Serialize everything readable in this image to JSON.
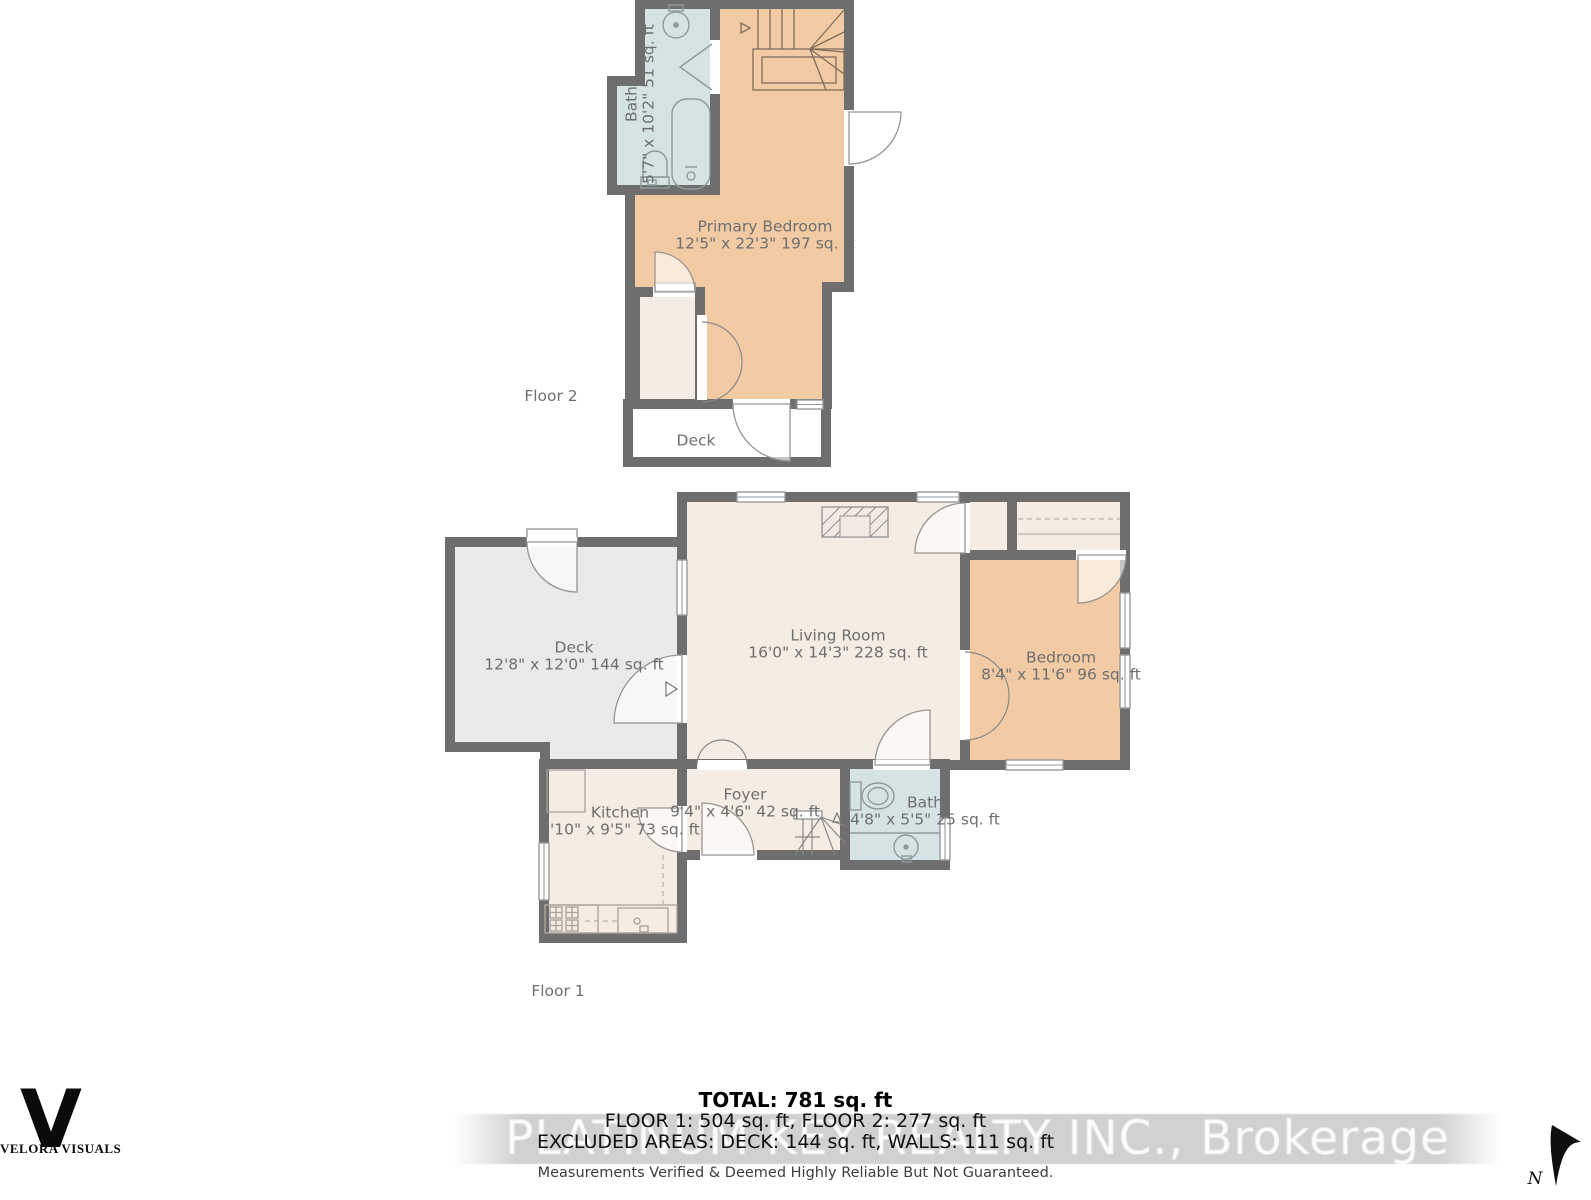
{
  "floor2": {
    "label": "Floor 2",
    "bath": {
      "name": "Bath",
      "dims": "5'7\" x 10'2\" 51 sq. ft"
    },
    "primary_bedroom": {
      "name": "Primary Bedroom",
      "dims": "12'5\" x 22'3\" 197 sq. ft"
    },
    "deck": {
      "name": "Deck"
    }
  },
  "floor1": {
    "label": "Floor 1",
    "deck": {
      "name": "Deck",
      "dims": "12'8\" x 12'0\" 144 sq. ft"
    },
    "living_room": {
      "name": "Living Room",
      "dims": "16'0\" x 14'3\" 228 sq. ft"
    },
    "bedroom": {
      "name": "Bedroom",
      "dims": "8'4\" x 11'6\" 96 sq. ft"
    },
    "kitchen": {
      "name": "Kitchen",
      "dims": "7'10\" x 9'5\" 73 sq. ft"
    },
    "foyer": {
      "name": "Foyer",
      "dims": "9'4\" x 4'6\" 42 sq. ft"
    },
    "bath": {
      "name": "Bath",
      "dims": "4'8\" x 5'5\" 25 sq. ft"
    }
  },
  "summary": {
    "total": "TOTAL: 781 sq. ft",
    "floors": "FLOOR 1: 504 sq. ft, FLOOR 2: 277 sq. ft",
    "excluded": "EXCLUDED AREAS: DECK: 144 sq. ft, WALLS: 111 sq. ft",
    "disclaimer": "Measurements Verified & Deemed Highly Reliable But Not Guaranteed."
  },
  "watermark": "PLATINUM KEY REALTY INC., Brokerage",
  "branding": {
    "logo_letter": "V",
    "logo_name": "VELORA VISUALS"
  },
  "compass": {
    "north_label": "N"
  },
  "colors": {
    "wall": "#6e6e6e",
    "room_warm": "#f2cba4",
    "room_neutral": "#f5ece4",
    "room_bath": "#d5e3e5",
    "deck_gray": "#e9eaeb",
    "label_text": "#6f6f6f"
  }
}
